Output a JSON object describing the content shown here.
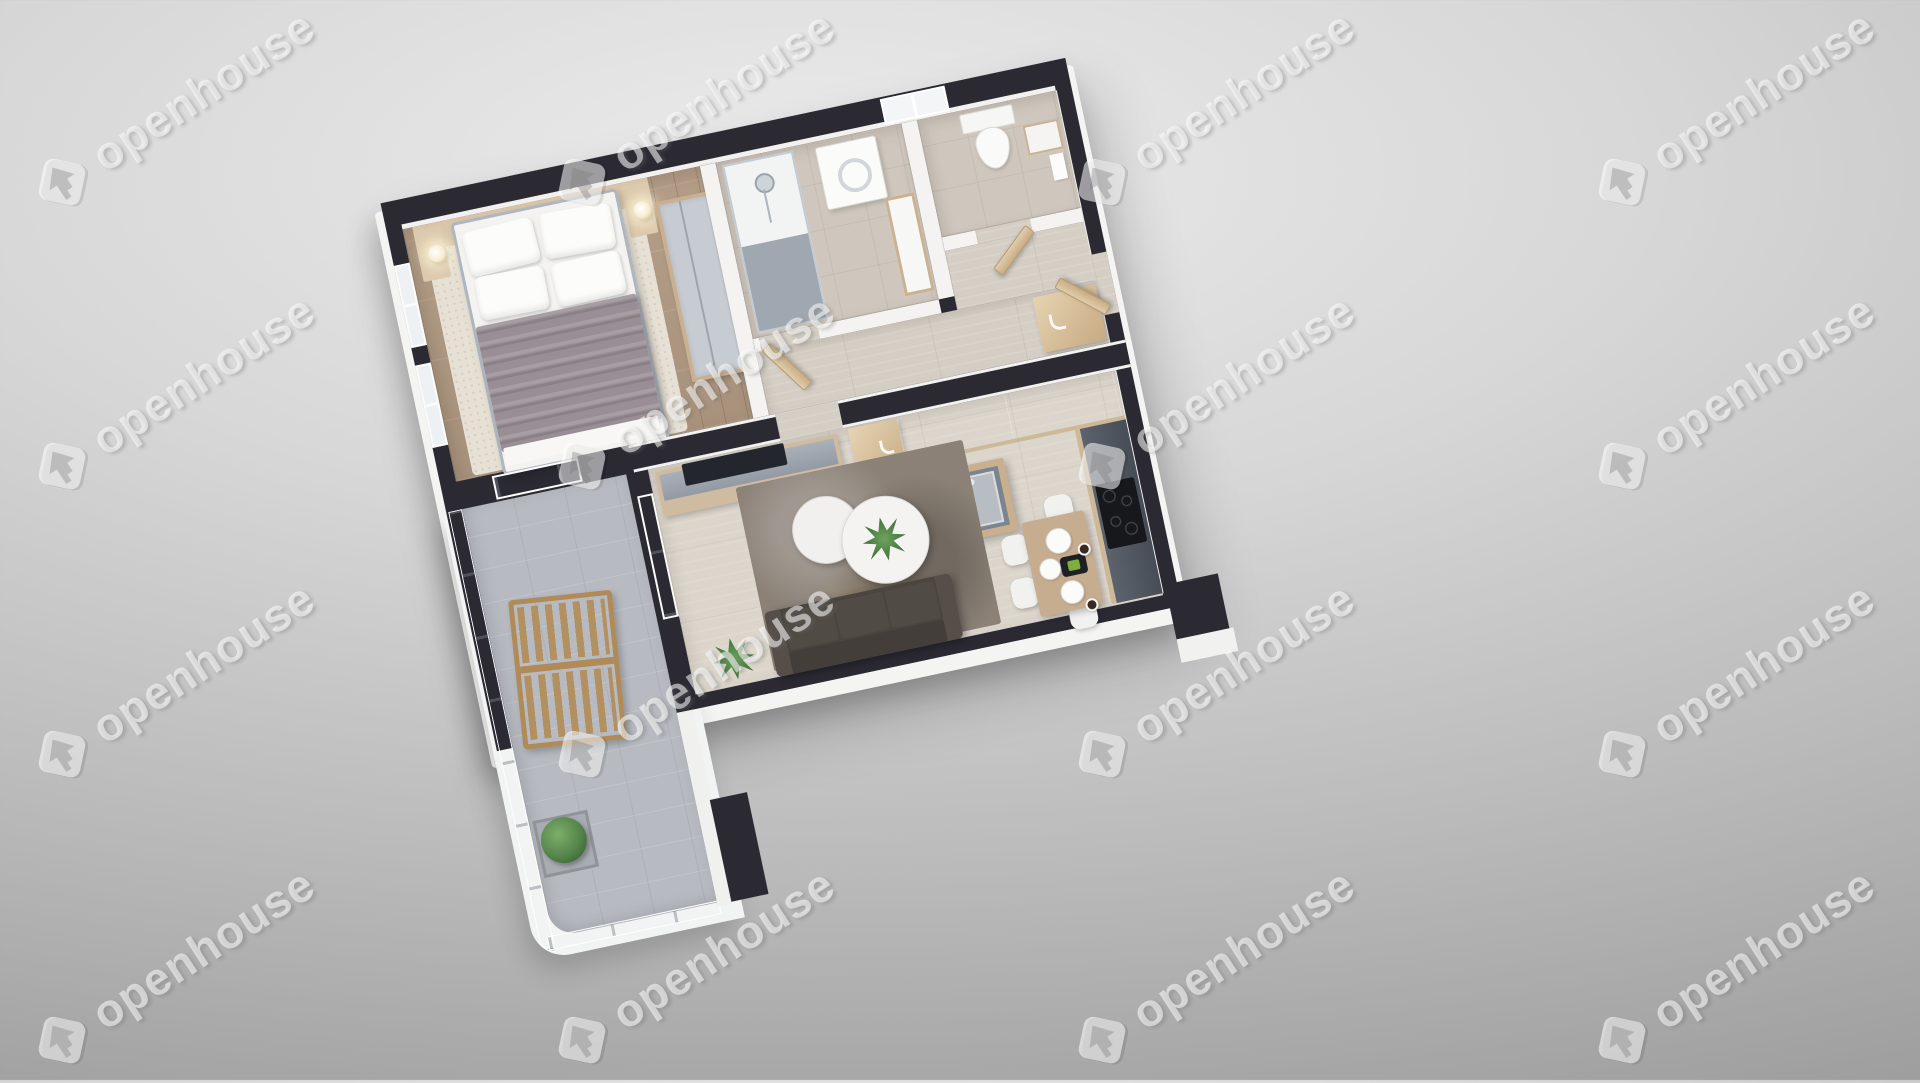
{
  "scene": {
    "type": "3d-floor-plan-render",
    "view": "isometric-top-down",
    "rotation_deg": -12,
    "description": "Photorealistic 3D floor plan of a one-bedroom apartment with balcony"
  },
  "watermark": {
    "text": "openhouse",
    "logo": "openhouse-arrow-logo",
    "angle_deg": -33,
    "color": "#ffffff",
    "opacity": 0.55
  },
  "background": {
    "light": "#ebebeb",
    "dark": "#9d9d9d"
  },
  "palette": {
    "exterior_wall": "#2b2a33",
    "interior_wall": "#f4f3f1",
    "wood_floor": "#b09a84",
    "hall_tile": "#d5cec4",
    "living_tile": "#dbd5cb",
    "bath_tile": "#cfc7bd",
    "balcony_tile": "#b7bbc1",
    "door_wood": "#d8c3a2",
    "counter_dark": "#4c525b",
    "counter_light": "#b9bdc4",
    "sofa": "#4b4540",
    "bed_blanket": "#998e95",
    "living_rug": "#8b8177",
    "bedroom_rug": "#e7e0d4",
    "plant_green": "#4e8347",
    "deck_chair_wood": "#b08a57"
  },
  "rooms": [
    {
      "name": "bedroom",
      "floor": "wood",
      "items": [
        "double-bed",
        "pillows",
        "blanket",
        "nightstands",
        "bedside-lamps",
        "area-rug",
        "wardrobe",
        "left-wall-windows",
        "balcony-sliding-door"
      ]
    },
    {
      "name": "bathroom",
      "floor": "tile",
      "items": [
        "walk-in-shower",
        "washing-machine",
        "vanity-sink",
        "door"
      ]
    },
    {
      "name": "wc",
      "floor": "tile",
      "items": [
        "toilet",
        "hand-basin",
        "door"
      ]
    },
    {
      "name": "hallway",
      "floor": "tile",
      "items": [
        "storage-cabinet",
        "entrance-door"
      ]
    },
    {
      "name": "living-room-kitchen",
      "floor": "tile",
      "items": [
        "sofa",
        "area-rug",
        "round-coffee-tables",
        "houseplants",
        "tv-sideboard",
        "dining-table",
        "dining-chairs",
        "tableware",
        "kitchen-island-with-sink",
        "wall-counter",
        "induction-cooktop",
        "tall-cabinet",
        "balcony-sliding-door"
      ]
    },
    {
      "name": "balcony",
      "floor": "tile",
      "items": [
        "glass-balustrade",
        "wooden-deck-chair",
        "planter-shrub"
      ]
    }
  ]
}
